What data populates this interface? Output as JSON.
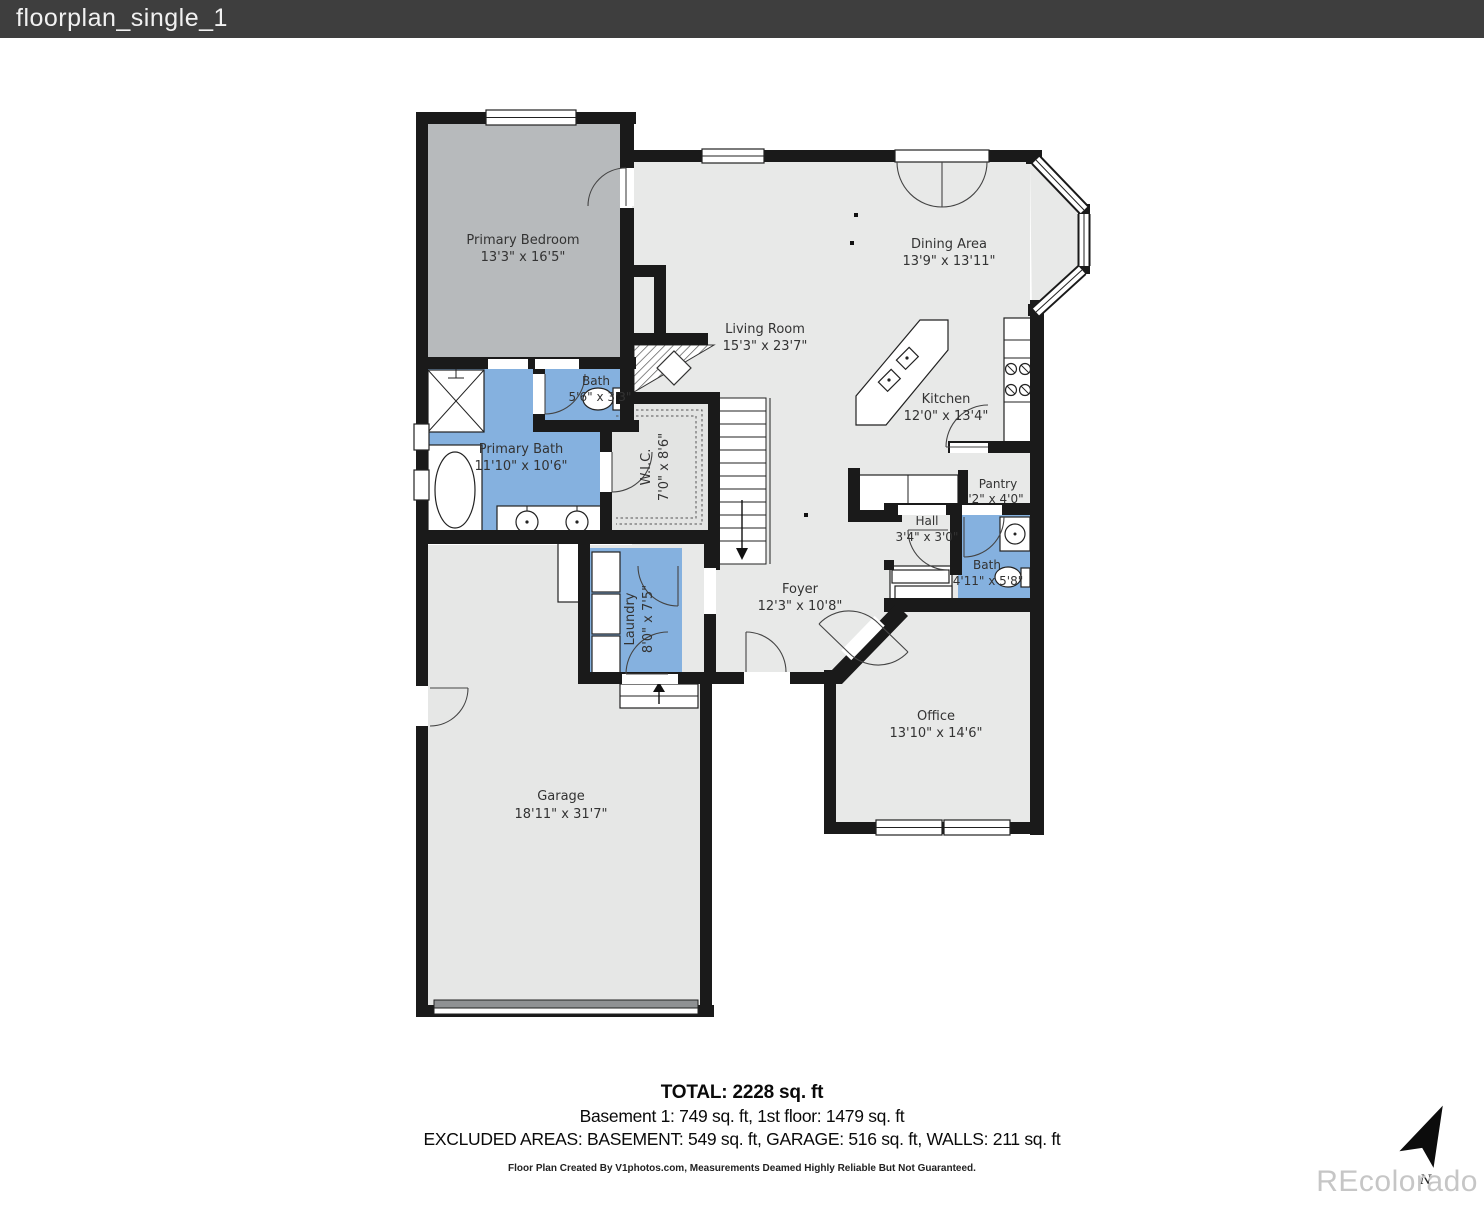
{
  "window": {
    "title": "floorplan_single_1"
  },
  "rooms": {
    "primary_bedroom": {
      "name": "Primary Bedroom",
      "dims": "13'3\" x 16'5\""
    },
    "dining": {
      "name": "Dining Area",
      "dims": "13'9\" x 13'11\""
    },
    "living": {
      "name": "Living Room",
      "dims": "15'3\" x 23'7\""
    },
    "kitchen": {
      "name": "Kitchen",
      "dims": "12'0\" x 13'4\""
    },
    "bath_upper": {
      "name": "Bath",
      "dims": "5'6\" x 3'3\""
    },
    "primary_bath": {
      "name": "Primary Bath",
      "dims": "11'10\" x 10'6\""
    },
    "wic": {
      "name": "W.I.C.",
      "dims": "7'0\" x 8'6\""
    },
    "pantry": {
      "name": "Pantry",
      "dims": "'2\" x 4'0\""
    },
    "hall": {
      "name": "Hall",
      "dims": "3'4\" x 3'0\""
    },
    "bath_lower": {
      "name": "Bath",
      "dims": "4'11\" x 5'8\""
    },
    "foyer": {
      "name": "Foyer",
      "dims": "12'3\" x 10'8\""
    },
    "laundry": {
      "name": "Laundry",
      "dims": "8'0\" x 7'5\""
    },
    "office": {
      "name": "Office",
      "dims": "13'10\" x 14'6\""
    },
    "garage": {
      "name": "Garage",
      "dims": "18'11\" x 31'7\""
    }
  },
  "summary": {
    "total": "TOTAL: 2228 sq. ft",
    "floors": "Basement 1: 749 sq. ft, 1st floor: 1479 sq. ft",
    "excluded": "EXCLUDED AREAS: BASEMENT: 549 sq. ft, GARAGE: 516 sq. ft, WALLS: 211 sq. ft",
    "disclaimer": "Floor Plan Created By V1photos.com, Measurements Deamed Highly Reliable But Not Guaranteed."
  },
  "watermark": {
    "brand": "REcolorado",
    "north": "N"
  },
  "colors": {
    "titlebar_bg": "#3e3e3e",
    "floor_gray": "#e8e9e8",
    "bedroom_gray": "#b7babc",
    "bath_blue": "#85b1df",
    "wall_black": "#1a1a1a",
    "watermark_gray": "#c6c6c6"
  }
}
